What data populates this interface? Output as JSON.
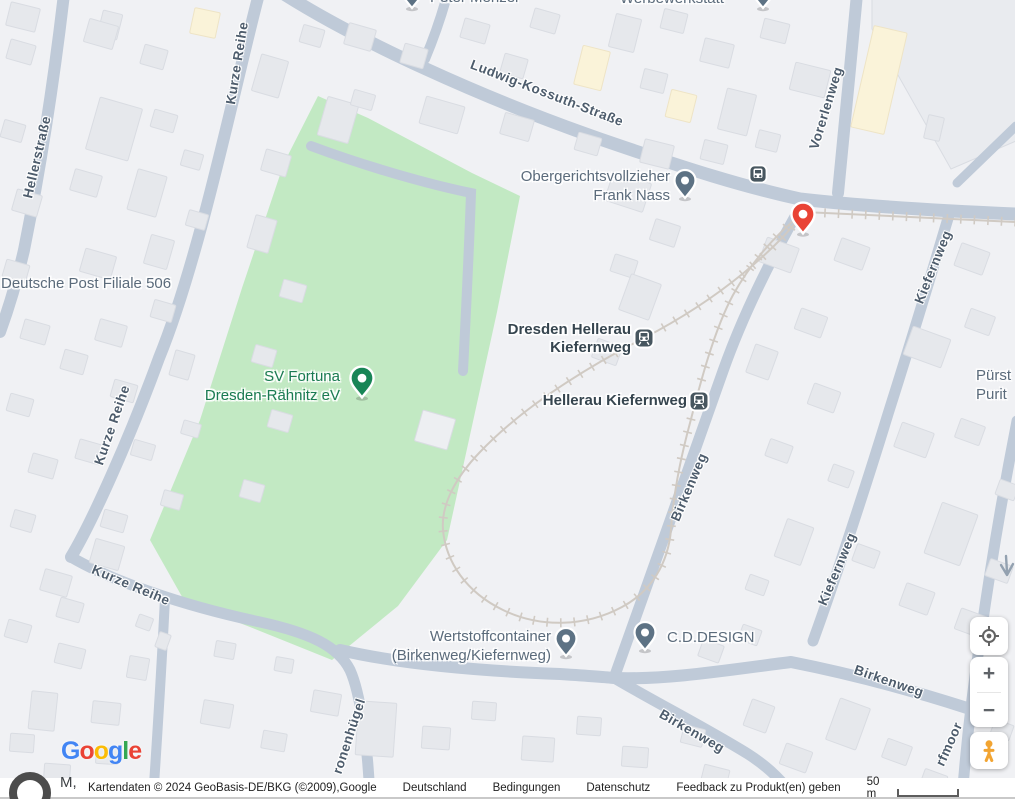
{
  "map": {
    "colors": {
      "background": "#f0f1f4",
      "road": "#bfcad8",
      "park": "#c2e9c3",
      "building": "#e6e8ec",
      "building_stroke": "#d9dce2",
      "building_light": "#edeff2",
      "building_yellow": "#faf3d9",
      "building_yellow_stroke": "#eee4c6",
      "lot": "#e9ebef",
      "rail": "#d0cac3",
      "street_text": "#4d5c6c",
      "poi_text": "#5b6b7b",
      "station_text": "#36454f",
      "park_text": "#1a7a52",
      "pin_gray": "#5d7284",
      "pin_green": "#188556",
      "pin_red": "#e94335",
      "station_icon": "#47565f"
    },
    "park_points": "318,96 368,118 472,173 520,196 497,312 447,540 398,606 332,660 250,627 185,602 150,540 200,420 242,288 284,163",
    "lot_points": "872,-6 1016,-6 1016,141 951,169 872,29",
    "driveways": [
      "M 311,146 C 370,168 432,185 471,193 C 469,252 466,312 463,371"
    ],
    "roads": [
      {
        "name": "hellerstrasse",
        "d": "M 64,-6 C 54,80 42,160 24,250 C 16,285 8,310 0,332",
        "w": 12
      },
      {
        "name": "kurze-reihe-upper",
        "d": "M 259,-6 C 236,80 201,255 159,358 C 129,440 92,522 71,557",
        "w": 12
      },
      {
        "name": "kurze-reihe-bend-kronenhuegel",
        "d": "M 71,557 C 110,580 180,605 260,622 C 310,633 338,646 350,670 C 360,692 368,745 370,800",
        "w": 11
      },
      {
        "name": "park-south-birkenweg",
        "d": "M 340,650 C 400,664 480,671 560,674 C 590,676 605,677 614,678 C 668,680 728,670 791,662 C 872,678 936,698 967,708",
        "w": 12
      },
      {
        "name": "birkenweg-lower-spur",
        "d": "M 616,679 C 655,702 706,728 748,754 C 770,768 784,783 796,800",
        "w": 11
      },
      {
        "name": "ludwig-kossuth-strasse",
        "d": "M 284,-6 C 360,42 480,97 600,139 C 690,170 745,187 800,199 C 870,207 945,211 1016,214",
        "w": 13
      },
      {
        "name": "top-stub",
        "d": "M 448,-8 C 441,18 433,40 425,59",
        "w": 10
      },
      {
        "name": "vorerlenweg",
        "d": "M 857,-6 C 851,60 844,130 838,193",
        "w": 12
      },
      {
        "name": "kiefernweg",
        "d": "M 949,215 C 938,252 914,332 888,414 C 869,476 838,572 813,641",
        "w": 11
      },
      {
        "name": "birkenweg-upper",
        "d": "M 801,206 C 777,248 746,306 723,371 C 703,428 642,600 614,678",
        "w": 11
      },
      {
        "name": "right-edge-torfmoor",
        "d": "M 1017,421 C 1005,482 991,562 980,641 C 972,694 966,745 962,800",
        "w": 11
      },
      {
        "name": "bottom-left-stub",
        "d": "M 165,598 C 162,660 157,740 153,800",
        "w": 10
      },
      {
        "name": "lot-slip",
        "d": "M 1016,126 L 957,183",
        "w": 9
      }
    ],
    "rail": {
      "d": "M 1016,222 C 940,218 870,215 804,212 C 778,247 723,297 644,338 C 580,371 520,410 480,452 C 455,478 441,505 443,530 C 446,562 466,592 503,610 C 540,628 585,627 622,607 C 652,591 668,563 671,530 C 673,498 680,460 690,423 C 700,384 714,330 733,295 C 752,261 776,234 804,212"
    },
    "oneway_arrow": {
      "d": "M 1006,556 L 1007,572 M 1001,565 L 1007,575 L 1013,564"
    },
    "buildings": [
      [
        8,
        5,
        30,
        24,
        14
      ],
      [
        100,
        12,
        20,
        26,
        14
      ],
      [
        8,
        42,
        26,
        20,
        16
      ],
      [
        2,
        122,
        22,
        18,
        16
      ],
      [
        14,
        192,
        26,
        22,
        16
      ],
      [
        4,
        262,
        24,
        18,
        16
      ],
      [
        22,
        322,
        26,
        20,
        16
      ],
      [
        8,
        396,
        24,
        18,
        16
      ],
      [
        30,
        456,
        26,
        20,
        16
      ],
      [
        12,
        512,
        22,
        18,
        16
      ],
      [
        42,
        572,
        28,
        22,
        16
      ],
      [
        6,
        622,
        24,
        18,
        16
      ],
      [
        56,
        646,
        28,
        20,
        14
      ],
      [
        30,
        692,
        26,
        38,
        6
      ],
      [
        92,
        702,
        28,
        22,
        6
      ],
      [
        10,
        734,
        24,
        18,
        4
      ],
      [
        44,
        764,
        26,
        18,
        4
      ],
      [
        96,
        748,
        22,
        16,
        4
      ],
      [
        92,
        542,
        30,
        25,
        16
      ],
      [
        58,
        600,
        24,
        20,
        16
      ],
      [
        86,
        22,
        30,
        24,
        16
      ],
      [
        142,
        47,
        24,
        20,
        16
      ],
      [
        92,
        102,
        44,
        54,
        16
      ],
      [
        152,
        112,
        24,
        18,
        16
      ],
      [
        72,
        172,
        28,
        22,
        16
      ],
      [
        132,
        172,
        30,
        42,
        16
      ],
      [
        182,
        152,
        20,
        16,
        16
      ],
      [
        82,
        252,
        32,
        24,
        16
      ],
      [
        147,
        237,
        24,
        30,
        16
      ],
      [
        187,
        212,
        20,
        16,
        16
      ],
      [
        97,
        322,
        28,
        22,
        16
      ],
      [
        152,
        302,
        22,
        18,
        16
      ],
      [
        62,
        352,
        24,
        20,
        16
      ],
      [
        112,
        382,
        24,
        18,
        16
      ],
      [
        172,
        352,
        20,
        26,
        16
      ],
      [
        77,
        442,
        26,
        20,
        16
      ],
      [
        132,
        442,
        22,
        16,
        16
      ],
      [
        182,
        422,
        18,
        14,
        16
      ],
      [
        102,
        512,
        24,
        18,
        16
      ],
      [
        162,
        492,
        20,
        16,
        16
      ],
      [
        137,
        616,
        15,
        13,
        20
      ],
      [
        157,
        633,
        12,
        16,
        20
      ],
      [
        128,
        657,
        20,
        22,
        10
      ],
      [
        215,
        642,
        20,
        16,
        10
      ],
      [
        275,
        658,
        18,
        14,
        10
      ],
      [
        256,
        57,
        28,
        38,
        16
      ],
      [
        301,
        27,
        22,
        18,
        16
      ],
      [
        263,
        152,
        26,
        22,
        16
      ],
      [
        251,
        217,
        22,
        34,
        16
      ],
      [
        281,
        282,
        24,
        18,
        16
      ],
      [
        253,
        347,
        22,
        18,
        16
      ],
      [
        269,
        412,
        22,
        18,
        16
      ],
      [
        241,
        482,
        22,
        18,
        16
      ],
      [
        322,
        100,
        32,
        40,
        16
      ],
      [
        418,
        414,
        34,
        32,
        16,
        "light"
      ],
      [
        192,
        10,
        26,
        26,
        12,
        "yellow"
      ],
      [
        346,
        26,
        28,
        22,
        16
      ],
      [
        402,
        46,
        24,
        20,
        16
      ],
      [
        462,
        21,
        26,
        20,
        16
      ],
      [
        352,
        92,
        22,
        16,
        16
      ],
      [
        422,
        101,
        40,
        28,
        16
      ],
      [
        502,
        56,
        24,
        20,
        16
      ],
      [
        532,
        11,
        26,
        20,
        16
      ],
      [
        578,
        48,
        28,
        40,
        14,
        "yellow"
      ],
      [
        612,
        16,
        26,
        34,
        14
      ],
      [
        642,
        71,
        24,
        20,
        14
      ],
      [
        502,
        116,
        30,
        22,
        16
      ],
      [
        662,
        11,
        24,
        20,
        14
      ],
      [
        702,
        41,
        30,
        24,
        14
      ],
      [
        668,
        92,
        26,
        28,
        14,
        "yellow"
      ],
      [
        722,
        91,
        30,
        42,
        14
      ],
      [
        762,
        21,
        26,
        20,
        14
      ],
      [
        792,
        66,
        36,
        28,
        14
      ],
      [
        702,
        142,
        24,
        20,
        14
      ],
      [
        757,
        132,
        22,
        18,
        14
      ],
      [
        642,
        142,
        30,
        24,
        14
      ],
      [
        576,
        135,
        24,
        18,
        16
      ],
      [
        608,
        177,
        40,
        30,
        18
      ],
      [
        652,
        222,
        26,
        22,
        18
      ],
      [
        612,
        257,
        24,
        18,
        18
      ],
      [
        862,
        28,
        34,
        104,
        13,
        "yellow"
      ],
      [
        926,
        116,
        16,
        24,
        13
      ],
      [
        957,
        247,
        30,
        24,
        20
      ],
      [
        907,
        332,
        40,
        30,
        20
      ],
      [
        967,
        312,
        26,
        20,
        20
      ],
      [
        897,
        427,
        34,
        26,
        20
      ],
      [
        957,
        422,
        26,
        20,
        20
      ],
      [
        932,
        507,
        38,
        54,
        20
      ],
      [
        987,
        562,
        24,
        18,
        20
      ],
      [
        902,
        587,
        30,
        24,
        20
      ],
      [
        957,
        612,
        28,
        22,
        20
      ],
      [
        997,
        482,
        20,
        16,
        20
      ],
      [
        837,
        242,
        30,
        24,
        20
      ],
      [
        762,
        242,
        34,
        26,
        20
      ],
      [
        797,
        312,
        28,
        22,
        20
      ],
      [
        750,
        347,
        24,
        30,
        20
      ],
      [
        810,
        387,
        28,
        22,
        20
      ],
      [
        767,
        442,
        24,
        18,
        20
      ],
      [
        830,
        467,
        22,
        18,
        20
      ],
      [
        780,
        522,
        28,
        40,
        20
      ],
      [
        854,
        547,
        24,
        18,
        20
      ],
      [
        747,
        577,
        20,
        16,
        20
      ],
      [
        624,
        278,
        32,
        38,
        20
      ],
      [
        594,
        342,
        26,
        20,
        20
      ],
      [
        202,
        702,
        30,
        24,
        10
      ],
      [
        262,
        732,
        24,
        18,
        10
      ],
      [
        312,
        692,
        28,
        22,
        10
      ],
      [
        357,
        702,
        38,
        54,
        4
      ],
      [
        422,
        727,
        28,
        22,
        4
      ],
      [
        472,
        702,
        24,
        18,
        4
      ],
      [
        522,
        737,
        32,
        24,
        4
      ],
      [
        577,
        717,
        24,
        18,
        4
      ],
      [
        622,
        747,
        26,
        20,
        4
      ],
      [
        682,
        727,
        22,
        18,
        14
      ],
      [
        702,
        767,
        26,
        20,
        14
      ],
      [
        747,
        702,
        24,
        28,
        20
      ],
      [
        782,
        747,
        28,
        22,
        20
      ],
      [
        832,
        702,
        32,
        44,
        20
      ],
      [
        884,
        742,
        26,
        20,
        20
      ],
      [
        922,
        772,
        24,
        16,
        20
      ],
      [
        992,
        722,
        20,
        16,
        20
      ],
      [
        700,
        642,
        22,
        18,
        20
      ],
      [
        740,
        627,
        20,
        16,
        20
      ]
    ],
    "street_labels": [
      {
        "text": "Hellerstraße",
        "x": 37,
        "y": 157,
        "rot": -77
      },
      {
        "text": "Kurze Reihe",
        "x": 237,
        "y": 63,
        "rot": -81
      },
      {
        "text": "Kurze Reihe",
        "x": 112,
        "y": 425,
        "rot": -71
      },
      {
        "text": "Kurze Reihe",
        "x": 131,
        "y": 585,
        "rot": 23
      },
      {
        "text": "Ludwig-Kossuth-Straße",
        "x": 547,
        "y": 93,
        "rot": 21
      },
      {
        "text": "Vorerlenweg",
        "x": 826,
        "y": 108,
        "rot": -73
      },
      {
        "text": "Kiefernweg",
        "x": 933,
        "y": 267,
        "rot": -68
      },
      {
        "text": "Kiefernweg",
        "x": 837,
        "y": 569,
        "rot": -67
      },
      {
        "text": "Birkenweg",
        "x": 689,
        "y": 487,
        "rot": -67
      },
      {
        "text": "Birkenweg",
        "x": 692,
        "y": 731,
        "rot": 30
      },
      {
        "text": "Birkenweg",
        "x": 889,
        "y": 681,
        "rot": 19
      },
      {
        "text": "ronenhügel",
        "x": 349,
        "y": 736,
        "rot": -72
      },
      {
        "text": "rfmoor",
        "x": 949,
        "y": 744,
        "rot": -66
      }
    ],
    "poi_labels": [
      {
        "id": "peter-menzel",
        "lines": [
          "Peter Menzel"
        ],
        "x": 430,
        "y": -12,
        "align": "left",
        "cls": ""
      },
      {
        "id": "werbewerkstatt",
        "lines": [
          "Werbewerkstatt"
        ],
        "x": 620,
        "y": -11,
        "align": "left",
        "cls": ""
      },
      {
        "id": "obergerichtsvollzieher",
        "lines": [
          "Obergerichtsvollzieher",
          "Frank Nass"
        ],
        "x": 670,
        "y": 167,
        "align": "right",
        "cls": ""
      },
      {
        "id": "deutsche-post",
        "lines": [
          "Deutsche Post Filiale 506"
        ],
        "x": 1,
        "y": 274,
        "align": "left",
        "cls": ""
      },
      {
        "id": "sv-fortuna",
        "lines": [
          "SV Fortuna",
          "Dresden-Rähnitz eV"
        ],
        "x": 340,
        "y": 367,
        "align": "right",
        "cls": "green"
      },
      {
        "id": "dresden-hellerau-kiefernweg",
        "lines": [
          "Dresden Hellerau",
          "Kiefernweg"
        ],
        "x": 631,
        "y": 321,
        "align": "right",
        "cls": "station"
      },
      {
        "id": "hellerau-kiefernweg",
        "lines": [
          "Hellerau Kiefernweg"
        ],
        "x": 687,
        "y": 392,
        "align": "right",
        "cls": "station"
      },
      {
        "id": "wertstoffcontainer",
        "lines": [
          "Wertstoffcontainer",
          "(Birkenweg/Kiefernweg)"
        ],
        "x": 551,
        "y": 627,
        "align": "right",
        "cls": ""
      },
      {
        "id": "cd-design",
        "lines": [
          "C.D.DESIGN"
        ],
        "x": 667,
        "y": 628,
        "align": "left",
        "cls": ""
      },
      {
        "id": "puerst",
        "lines": [
          "Pürst",
          "Purit"
        ],
        "x": 976,
        "y": 366,
        "align": "left",
        "cls": ""
      }
    ],
    "markers": [
      {
        "type": "pin",
        "color": "gray",
        "x": 412,
        "y": -6,
        "name": "poi-pin-peter-menzel"
      },
      {
        "type": "pin",
        "color": "gray",
        "x": 763,
        "y": -6,
        "name": "poi-pin-werbewerkstatt"
      },
      {
        "type": "pin",
        "color": "gray",
        "x": 685,
        "y": 184,
        "name": "poi-pin-obergerichtsvollzieher"
      },
      {
        "type": "pin",
        "color": "gray",
        "x": 566,
        "y": 642,
        "name": "poi-pin-wertstoffcontainer"
      },
      {
        "type": "pin",
        "color": "gray",
        "x": 645,
        "y": 636,
        "name": "poi-pin-cd-design"
      },
      {
        "type": "pin",
        "color": "green",
        "x": 362,
        "y": 382,
        "name": "poi-pin-sv-fortuna"
      },
      {
        "type": "pin",
        "color": "red",
        "x": 803,
        "y": 218,
        "name": "red-destination-marker"
      },
      {
        "type": "station",
        "x": 644,
        "y": 338,
        "name": "station-icon-dresden-hellerau-kiefernweg"
      },
      {
        "type": "station",
        "x": 699,
        "y": 401,
        "name": "station-icon-hellerau-kiefernweg"
      },
      {
        "type": "bus",
        "x": 758,
        "y": 174,
        "name": "bus-stop-icon"
      }
    ]
  },
  "controls": {
    "zoom_in": "+",
    "zoom_out": "−"
  },
  "logo": {
    "letters": [
      {
        "ch": "G",
        "color": "#4285F4"
      },
      {
        "ch": "o",
        "color": "#EA4335"
      },
      {
        "ch": "o",
        "color": "#FBBC05"
      },
      {
        "ch": "g",
        "color": "#4285F4"
      },
      {
        "ch": "l",
        "color": "#34A853"
      },
      {
        "ch": "e",
        "color": "#EA4335"
      }
    ]
  },
  "attribution": {
    "cut_text": "M,",
    "map_data": "Kartendaten © 2024 GeoBasis-DE/BKG (©2009),Google",
    "country": "Deutschland",
    "terms": "Bedingungen",
    "privacy": "Datenschutz",
    "feedback": "Feedback zu Produkt(en) geben",
    "scale_text": "50 m"
  }
}
